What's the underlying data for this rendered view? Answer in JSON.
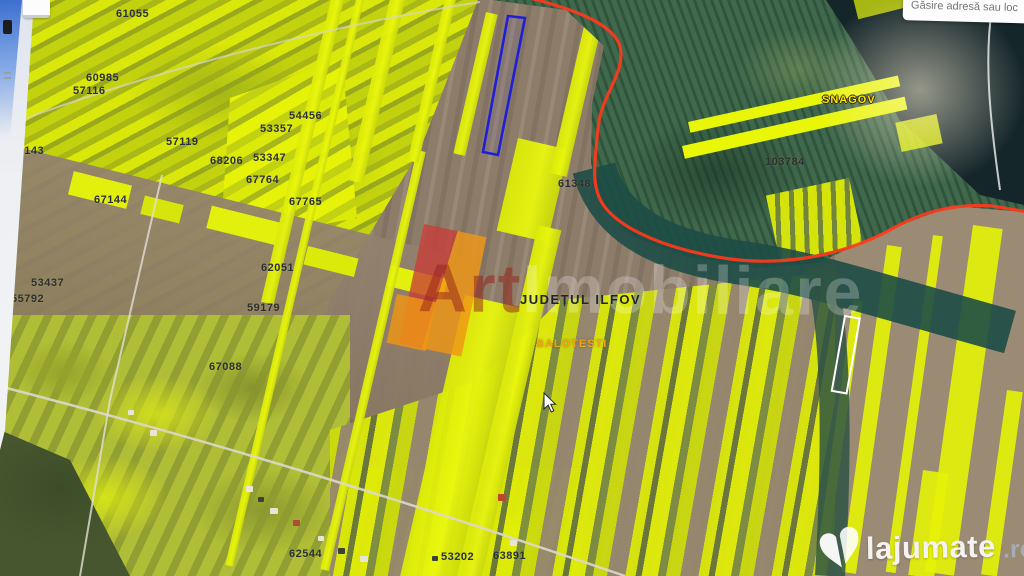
{
  "search_box": {
    "placeholder": "Găsire adresă sau loc"
  },
  "watermark": {
    "prefix": "Art",
    "suffix": "Imobiliare"
  },
  "brand": {
    "name": "lajumate",
    "tld": ".ro"
  },
  "map": {
    "county_label": "JUDEȚUL ILFOV",
    "localities": [
      {
        "name": "BALOTESTI"
      },
      {
        "name": "SNAGOV"
      }
    ],
    "parcel_labels": [
      "61055",
      "60985",
      "57116",
      "67143",
      "67144",
      "57119",
      "68206",
      "53357",
      "53347",
      "54456",
      "67764",
      "67765",
      "62051",
      "59179",
      "67088",
      "53437",
      "55792",
      "61348",
      "103784",
      "62544",
      "53202",
      "63891"
    ],
    "colors": {
      "parcel_yellow": "#e6f207",
      "field_brown": "#8d7c6a",
      "forest_green": "#3f684c",
      "water_teal": "#1d4c46",
      "boundary_red": "#ff3a1c",
      "selection_blue": "#1f1fd8",
      "highlight_red": "#c83c37",
      "highlight_orange": "#f09614",
      "balotesti_label": "#eda718",
      "snagov_label": "#ffe206",
      "label_dark": "#2a2f38"
    }
  }
}
